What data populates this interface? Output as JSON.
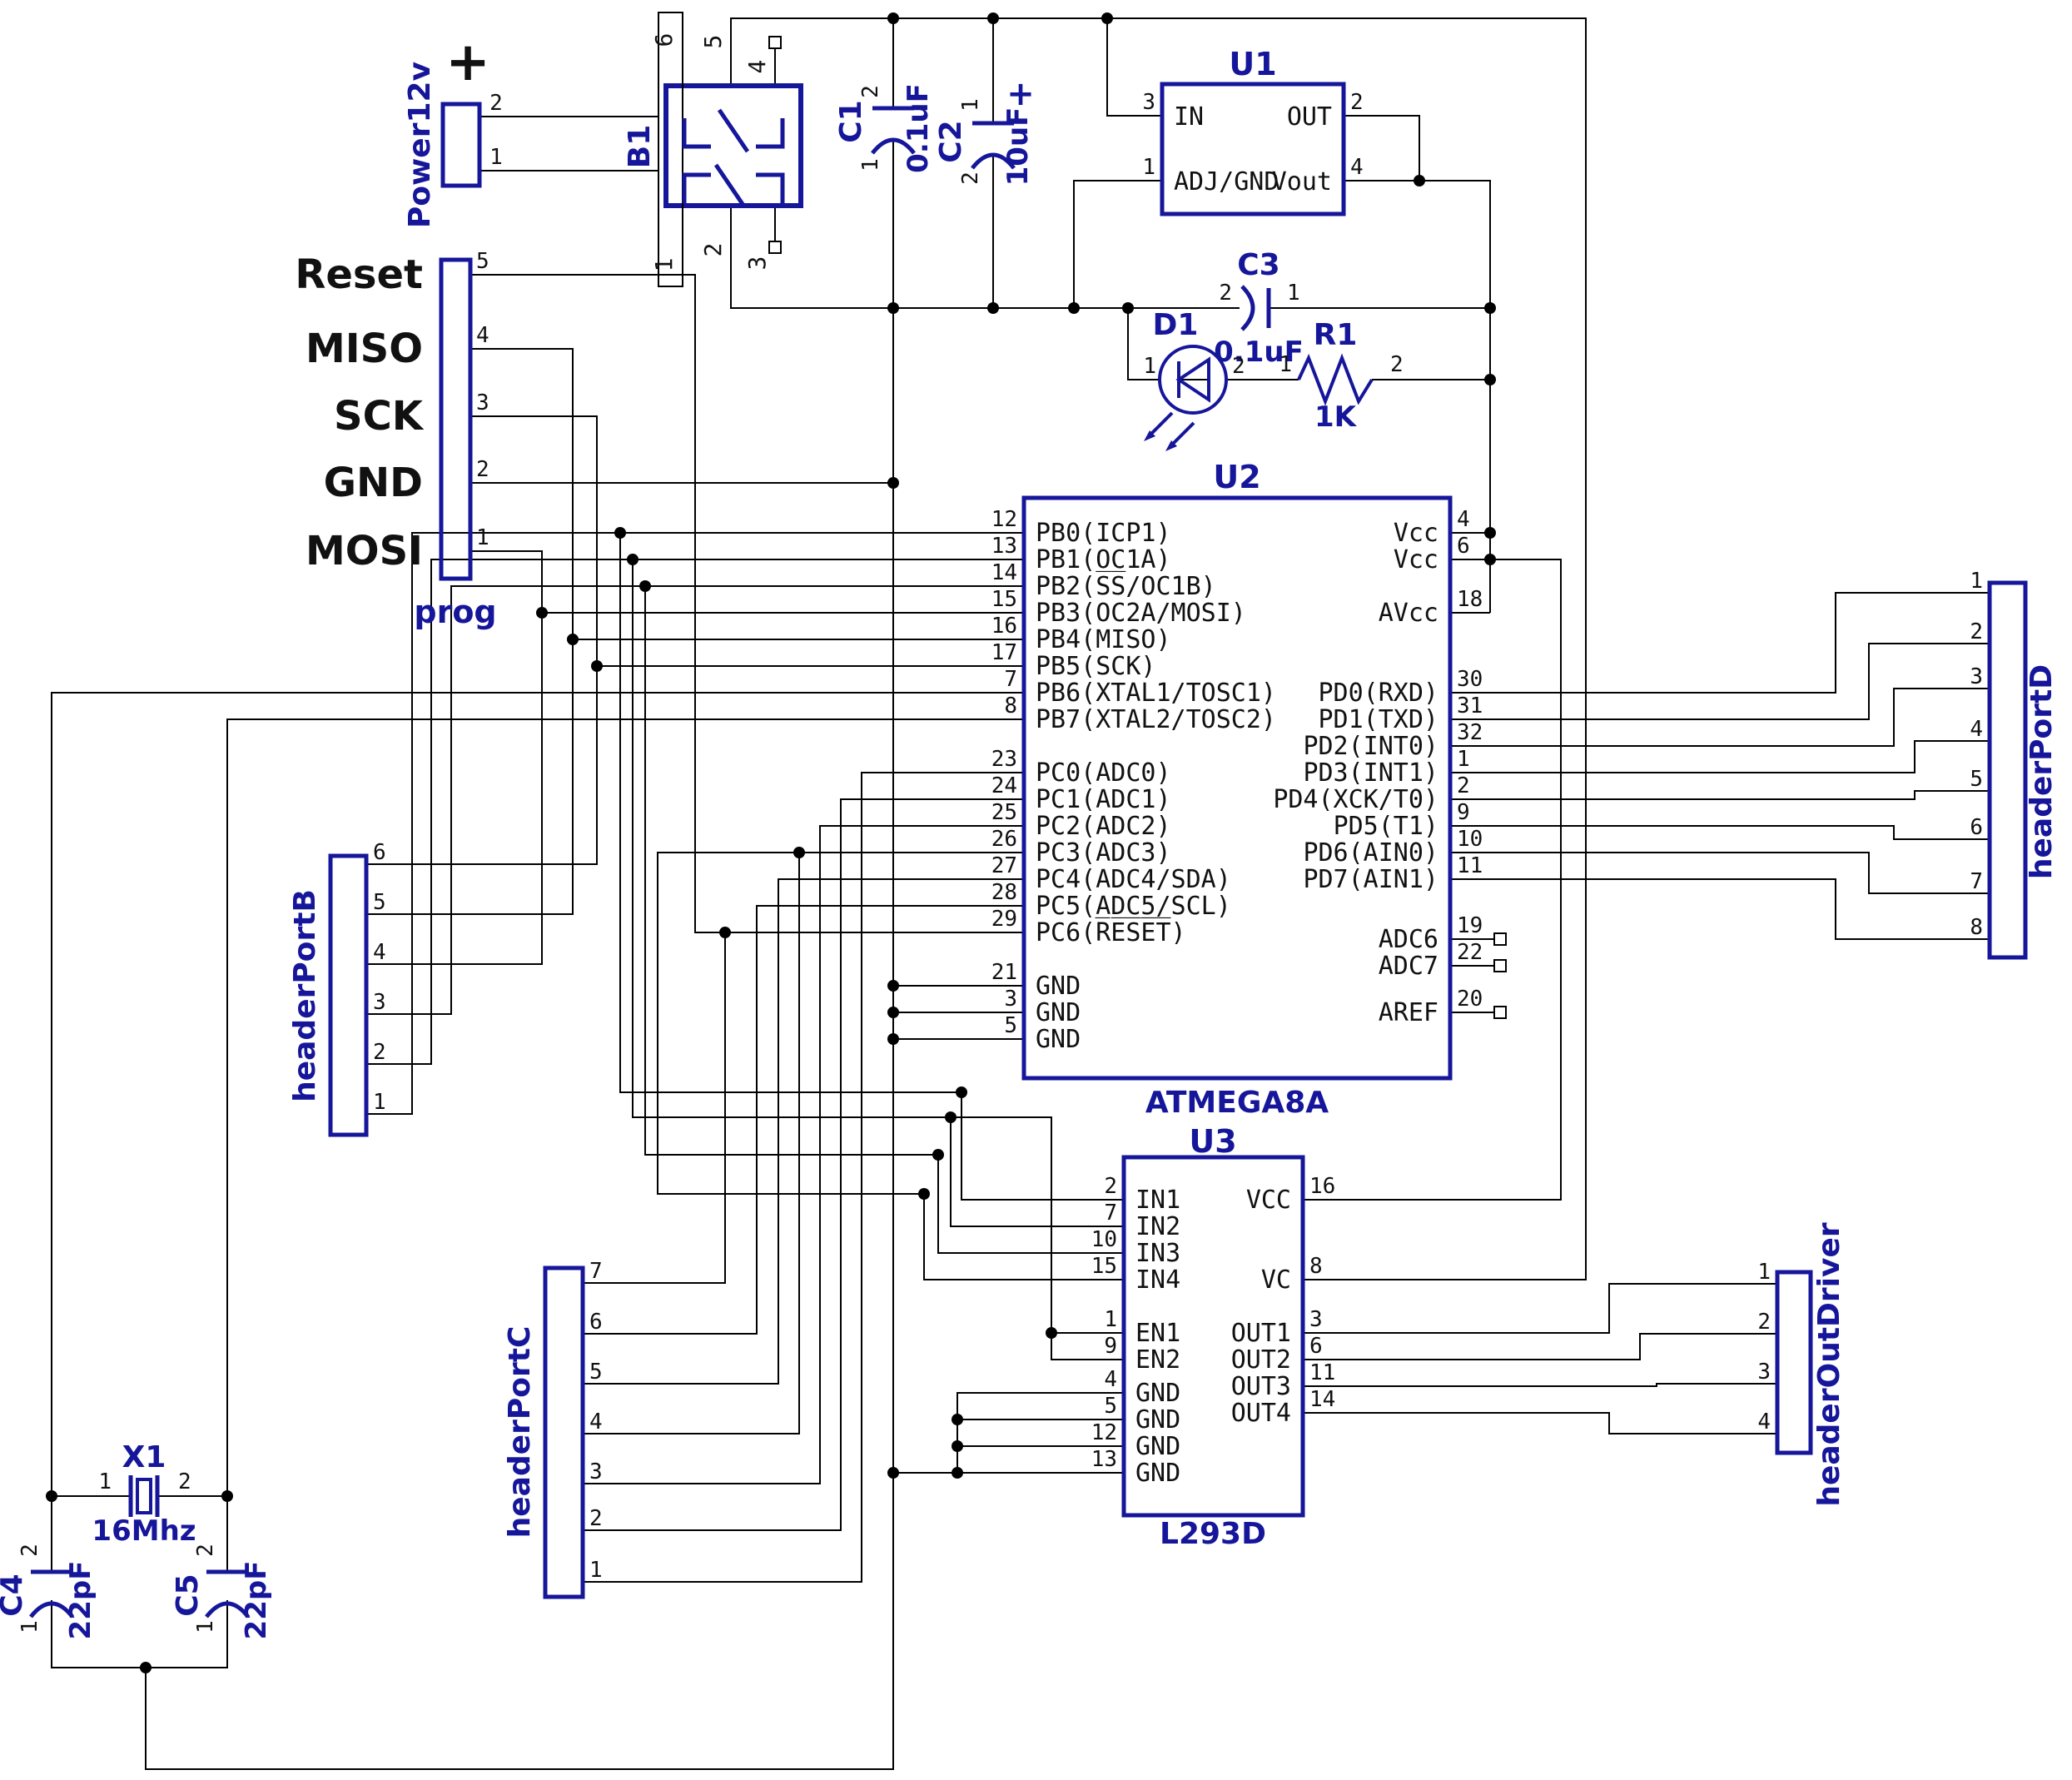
{
  "colors": {
    "component": "#16169b",
    "wire": "#000000",
    "text": "#111111"
  },
  "power12v": {
    "label": "Power12v",
    "plus": "+",
    "pin2": "2",
    "pin1": "1"
  },
  "bridge": {
    "label": "B1",
    "pad_top": "6",
    "pad_bottom": "1",
    "pin5": "5",
    "pin2": "2",
    "pin4": "4",
    "pin3": "3"
  },
  "c1": {
    "ref": "C1",
    "value": "0.1uF",
    "pin_top": "2",
    "pin_bottom": "1"
  },
  "c2": {
    "ref": "C2",
    "value": "10uF",
    "plus": "+",
    "pin_top": "1",
    "pin_bottom": "2"
  },
  "c3": {
    "ref": "C3",
    "value": "0.1uF",
    "pin_left": "2",
    "pin_right": "1"
  },
  "c4": {
    "ref": "C4",
    "value": "22pF",
    "pin_top": "2",
    "pin_bottom": "1"
  },
  "c5": {
    "ref": "C5",
    "value": "22pF",
    "pin_top": "2",
    "pin_bottom": "1"
  },
  "u1": {
    "ref": "U1",
    "pin_in": {
      "num": "3",
      "name": "IN"
    },
    "pin_adj": {
      "num": "1",
      "name": "ADJ/GND"
    },
    "pin_out": {
      "num": "2",
      "name": "OUT"
    },
    "pin_vout": {
      "num": "4",
      "name": "Vout"
    }
  },
  "d1": {
    "ref": "D1",
    "pin1": "1",
    "pin2": "2"
  },
  "r1": {
    "ref": "R1",
    "value": "1K",
    "pin1": "1",
    "pin2": "2"
  },
  "u2": {
    "ref": "U2",
    "part": "ATMEGA8A",
    "left_pins": [
      {
        "num": "12",
        "name": "PB0(ICP1)"
      },
      {
        "num": "13",
        "name": "PB1(OC1A)"
      },
      {
        "num": "14",
        "name": "PB2(S̅S̅/OC1B)"
      },
      {
        "num": "15",
        "name": "PB3(OC2A/MOSI)"
      },
      {
        "num": "16",
        "name": "PB4(MISO)"
      },
      {
        "num": "17",
        "name": "PB5(SCK)"
      },
      {
        "num": "7",
        "name": "PB6(XTAL1/TOSC1)"
      },
      {
        "num": "8",
        "name": "PB7(XTAL2/TOSC2)"
      },
      {
        "num": "23",
        "name": "PC0(ADC0)"
      },
      {
        "num": "24",
        "name": "PC1(ADC1)"
      },
      {
        "num": "25",
        "name": "PC2(ADC2)"
      },
      {
        "num": "26",
        "name": "PC3(ADC3)"
      },
      {
        "num": "27",
        "name": "PC4(ADC4/SDA)"
      },
      {
        "num": "28",
        "name": "PC5(ADC5/SCL)"
      },
      {
        "num": "29",
        "name": "PC6(R̅E̅S̅E̅T̅)"
      },
      {
        "num": "21",
        "name": "GND"
      },
      {
        "num": "3",
        "name": "GND"
      },
      {
        "num": "5",
        "name": "GND"
      }
    ],
    "right_pins": [
      {
        "num": "4",
        "name": "Vcc"
      },
      {
        "num": "6",
        "name": "Vcc"
      },
      {
        "num": "18",
        "name": "AVcc"
      },
      {
        "num": "30",
        "name": "PD0(RXD)"
      },
      {
        "num": "31",
        "name": "PD1(TXD)"
      },
      {
        "num": "32",
        "name": "PD2(INT0)"
      },
      {
        "num": "1",
        "name": "PD3(INT1)"
      },
      {
        "num": "2",
        "name": "PD4(XCK/T0)"
      },
      {
        "num": "9",
        "name": "PD5(T1)"
      },
      {
        "num": "10",
        "name": "PD6(AIN0)"
      },
      {
        "num": "11",
        "name": "PD7(AIN1)"
      },
      {
        "num": "19",
        "name": "ADC6"
      },
      {
        "num": "22",
        "name": "ADC7"
      },
      {
        "num": "20",
        "name": "AREF"
      }
    ]
  },
  "u3": {
    "ref": "U3",
    "part": "L293D",
    "left_pins": [
      {
        "num": "2",
        "name": "IN1"
      },
      {
        "num": "7",
        "name": "IN2"
      },
      {
        "num": "10",
        "name": "IN3"
      },
      {
        "num": "15",
        "name": "IN4"
      },
      {
        "num": "1",
        "name": "EN1"
      },
      {
        "num": "9",
        "name": "EN2"
      },
      {
        "num": "4",
        "name": "GND"
      },
      {
        "num": "5",
        "name": "GND"
      },
      {
        "num": "12",
        "name": "GND"
      },
      {
        "num": "13",
        "name": "GND"
      }
    ],
    "right_pins": [
      {
        "num": "16",
        "name": "VCC"
      },
      {
        "num": "8",
        "name": "VC"
      },
      {
        "num": "3",
        "name": "OUT1"
      },
      {
        "num": "6",
        "name": "OUT2"
      },
      {
        "num": "11",
        "name": "OUT3"
      },
      {
        "num": "14",
        "name": "OUT4"
      }
    ]
  },
  "prog": {
    "label": "prog",
    "signals": [
      "Reset",
      "MISO",
      "SCK",
      "GND",
      "MOSI"
    ],
    "pins": [
      "5",
      "4",
      "3",
      "2",
      "1"
    ]
  },
  "header_port_b": {
    "label": "headerPortB",
    "pins": [
      "6",
      "5",
      "4",
      "3",
      "2",
      "1"
    ]
  },
  "header_port_c": {
    "label": "headerPortC",
    "pins": [
      "7",
      "6",
      "5",
      "4",
      "3",
      "2",
      "1"
    ]
  },
  "header_port_d": {
    "label": "headerPortD",
    "pins": [
      "1",
      "2",
      "3",
      "4",
      "5",
      "6",
      "7",
      "8"
    ]
  },
  "header_out_driver": {
    "label": "headerOutDriver",
    "pins": [
      "1",
      "2",
      "3",
      "4"
    ]
  },
  "x1": {
    "ref": "X1",
    "value": "16Mhz",
    "pin1": "1",
    "pin2": "2"
  }
}
